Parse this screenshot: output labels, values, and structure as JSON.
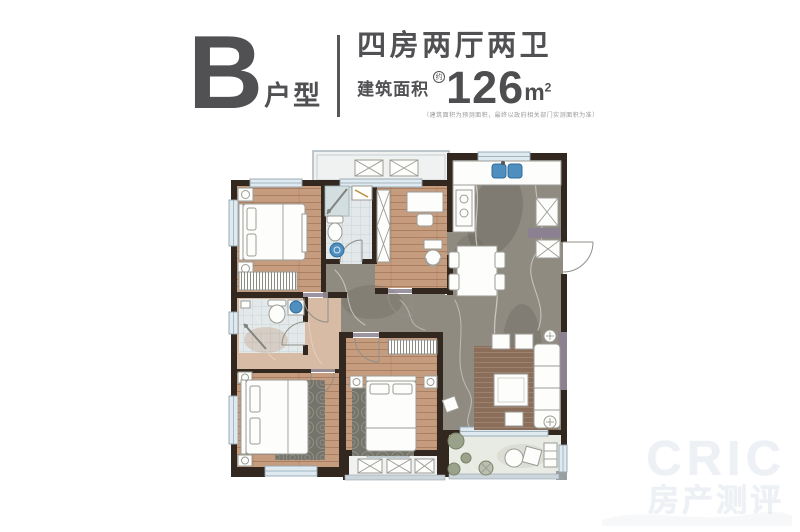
{
  "header": {
    "unit_letter": "B",
    "unit_suffix": "户型",
    "layout_title": "四房两厅两卫",
    "area_label": "建筑面积",
    "area_approx_mark": "约",
    "area_value": "126",
    "area_unit_main": "m",
    "area_unit_sup": "2",
    "disclaimer": "（建筑面积为预测面积，最终以政府相关部门实测面积为准）"
  },
  "watermark": {
    "brand": "CRIC",
    "brand_cn": "房产测评"
  },
  "floor_plan": {
    "description": "B户型 四房两厅两卫 平面图",
    "rooms": [
      {
        "id": "bedroom-top-left",
        "name": "卧室"
      },
      {
        "id": "bathroom-top",
        "name": "卫生间"
      },
      {
        "id": "study-bedroom",
        "name": "卧室/书房"
      },
      {
        "id": "kitchen",
        "name": "厨房"
      },
      {
        "id": "dining",
        "name": "餐厅"
      },
      {
        "id": "entry-hall",
        "name": "玄关过道"
      },
      {
        "id": "bathroom-left",
        "name": "卫生间"
      },
      {
        "id": "master-bedroom",
        "name": "主卧"
      },
      {
        "id": "bedroom-bottom-middle",
        "name": "卧室"
      },
      {
        "id": "living-room",
        "name": "客厅"
      },
      {
        "id": "balcony-top",
        "name": "设备平台"
      },
      {
        "id": "balcony-bottom",
        "name": "阳台"
      },
      {
        "id": "terrace",
        "name": "阳台"
      }
    ]
  },
  "colors": {
    "wall": "#332820",
    "wood": "#c69c7e",
    "tan": "#d7bba4",
    "marble": "#8f8b81",
    "tile": "#e3e9ea",
    "balcony": "#f0f2f1",
    "terrace": "#e8eae4",
    "windowFill": "#dfe9f0",
    "windowFrame": "#93a5b2",
    "fixtureBlue": "#4e8fc0",
    "accent": "#8c8191",
    "rugGray": "#75746a",
    "rugBrown": "#8a6e5a",
    "furniture": "#fdfdfc",
    "furnitureStroke": "#9b9b95",
    "railLight": "#ccd5da",
    "plant": "#9aa289",
    "headerText": "#515154",
    "divider": "#57575a",
    "disclaimer": "#9a9a9a",
    "watermark": "#edf0f4"
  }
}
